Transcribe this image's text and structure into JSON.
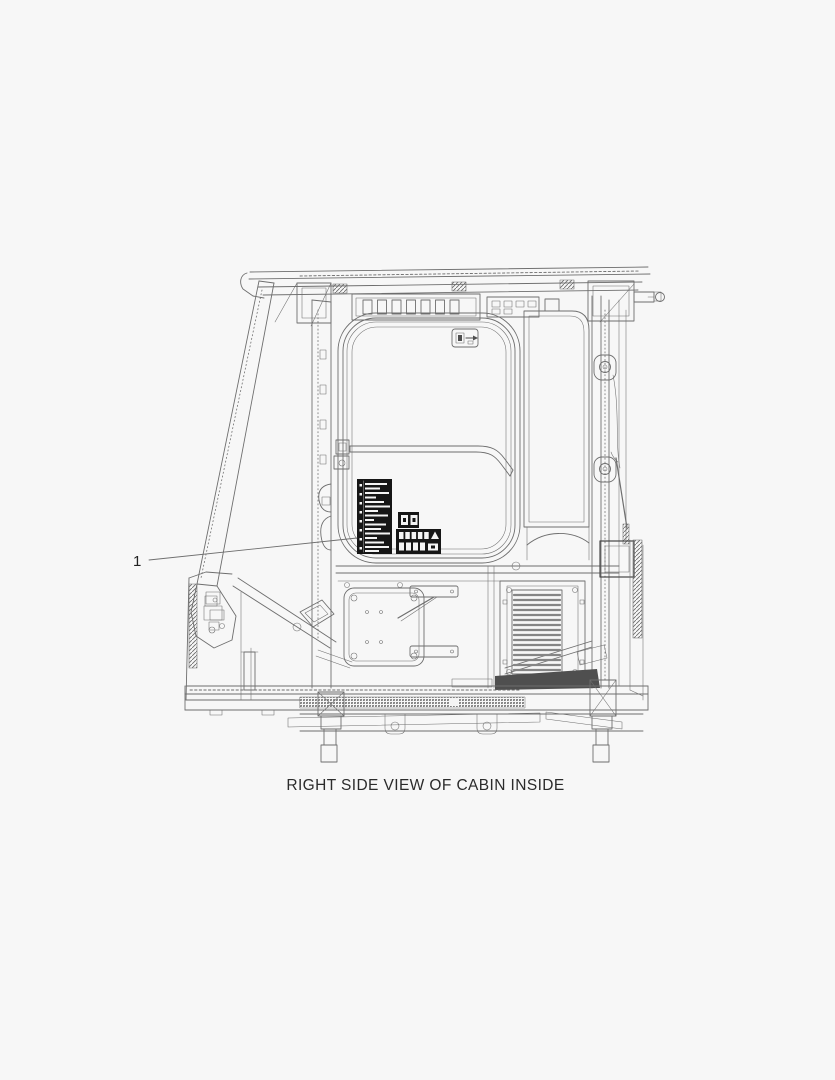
{
  "page": {
    "background_color": "#f7f7f7",
    "line_color": "#6e6e6e",
    "decal_color": "#161616"
  },
  "figure": {
    "caption": "RIGHT SIDE VIEW OF CABIN INSIDE",
    "callouts": [
      {
        "number": "1"
      }
    ]
  }
}
